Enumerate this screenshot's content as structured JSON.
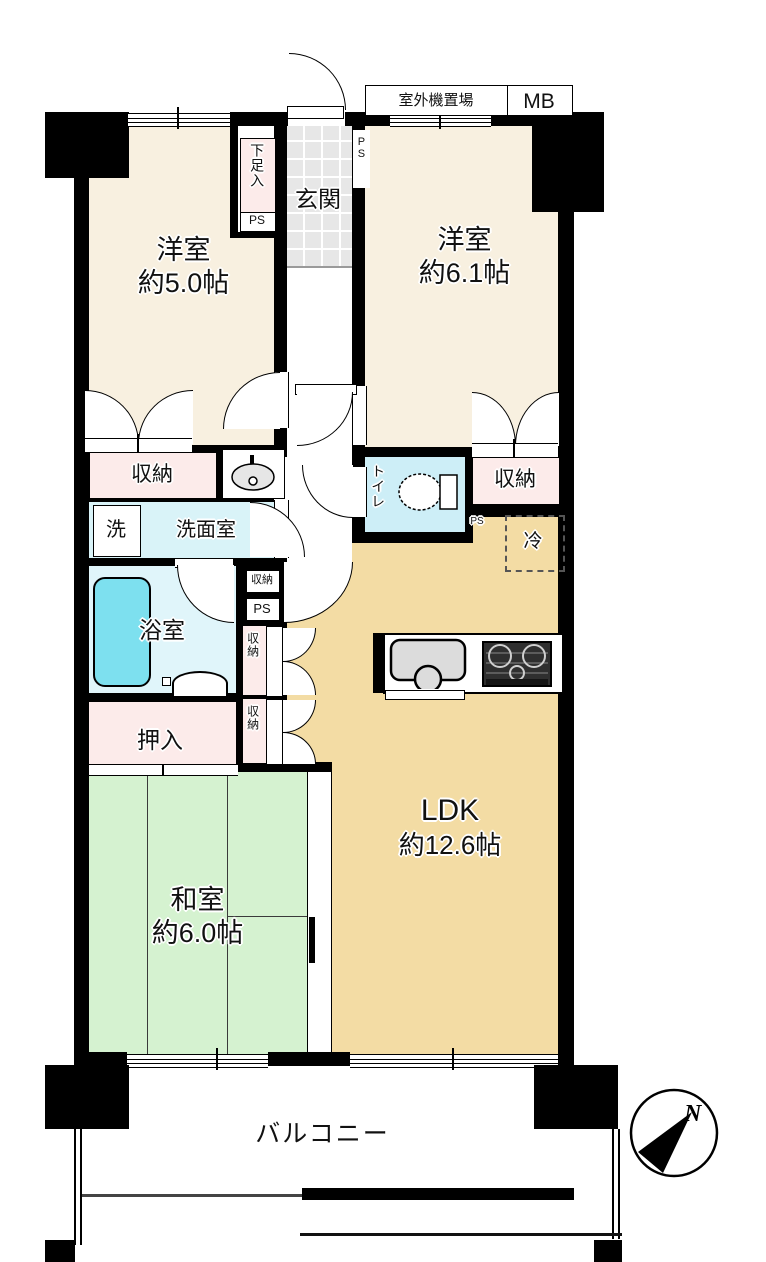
{
  "plan": {
    "rooms": {
      "western_room_1": {
        "name": "洋室",
        "area": "約5.0帖"
      },
      "western_room_2": {
        "name": "洋室",
        "area": "約6.1帖"
      },
      "ldk": {
        "name": "LDK",
        "area": "約12.6帖"
      },
      "japanese_room": {
        "name": "和室",
        "area": "約6.0帖"
      },
      "entrance": {
        "name": "玄関"
      },
      "washroom": {
        "name": "洗面室"
      },
      "bathroom": {
        "name": "浴室"
      },
      "toilet": {
        "name": "トイレ"
      },
      "balcony": {
        "name": "バルコニー"
      }
    },
    "storage": {
      "closet": "収納",
      "oshiire": "押入",
      "shoe_box": "下足入"
    },
    "fixtures": {
      "washer": "洗",
      "fridge": "冷",
      "pipe_space": "PS",
      "outdoor_unit_area": "室外機置場",
      "meter_box": "MB"
    },
    "compass": {
      "north": "N"
    },
    "colors": {
      "wall": "#000000",
      "western_room": "#f8f0e0",
      "ldk": "#f3dca4",
      "japanese_room": "#d5f2d0",
      "storage_pink": "#fcebea",
      "wet_area_blue": "#d9f3f8",
      "bathtub": "#7de0ef",
      "entrance_tile": "#e7e7e7"
    }
  }
}
